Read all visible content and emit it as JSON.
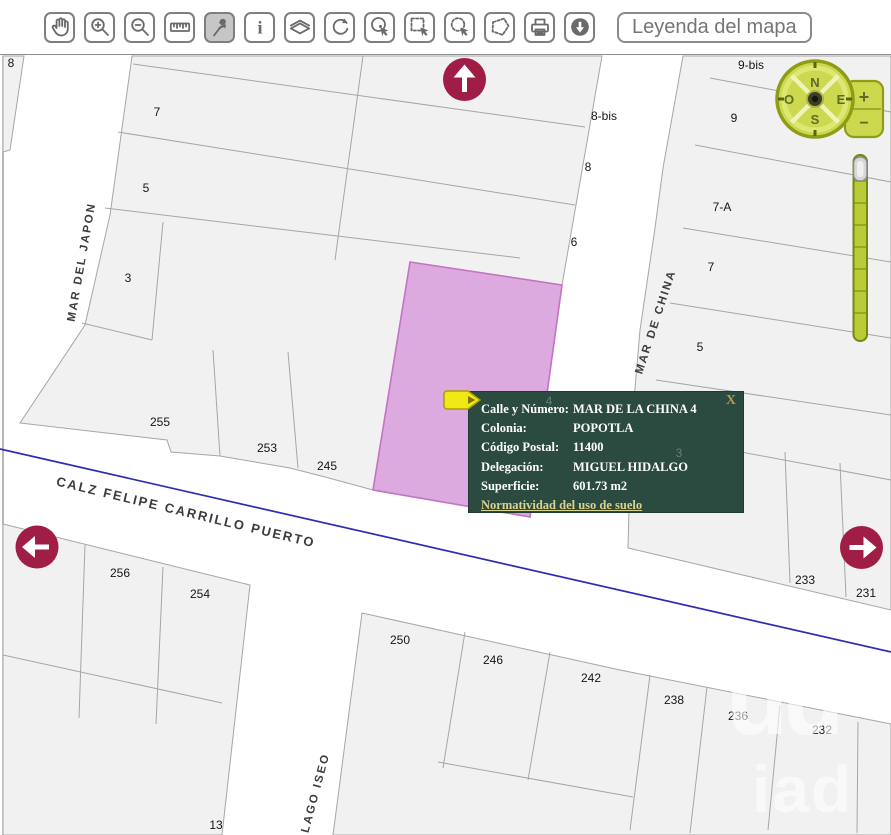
{
  "toolbar": {
    "buttons": [
      {
        "name": "pan",
        "icon": "hand-icon",
        "active": false
      },
      {
        "name": "zoom-in",
        "icon": "magnifier-plus-icon",
        "active": false
      },
      {
        "name": "zoom-out",
        "icon": "magnifier-minus-icon",
        "active": false
      },
      {
        "name": "measure",
        "icon": "ruler-icon",
        "active": false
      },
      {
        "name": "pin",
        "icon": "pushpin-icon",
        "active": true
      },
      {
        "name": "info",
        "icon": "info-icon",
        "active": false
      },
      {
        "name": "layers",
        "icon": "layers-icon",
        "active": false
      },
      {
        "name": "refresh",
        "icon": "refresh-icon",
        "active": false
      },
      {
        "name": "select-point",
        "icon": "circle-point-cursor-icon",
        "active": false
      },
      {
        "name": "select-rectangle",
        "icon": "dashed-rectangle-cursor-icon",
        "active": false
      },
      {
        "name": "select-circle",
        "icon": "dashed-circle-cursor-icon",
        "active": false
      },
      {
        "name": "select-polygon",
        "icon": "dashed-polygon-icon",
        "active": false
      },
      {
        "name": "print",
        "icon": "printer-icon",
        "active": false
      },
      {
        "name": "download",
        "icon": "download-icon",
        "active": false
      }
    ],
    "legend_button": "Leyenda del mapa"
  },
  "map": {
    "street_labels": [
      {
        "text": "MAR DEL JAPON",
        "x": 82,
        "y": 262,
        "angle": -80,
        "size": 11.5
      },
      {
        "text": "MAR DE CHINA",
        "x": 656,
        "y": 322,
        "angle": -72,
        "size": 11.5
      },
      {
        "text": "CALZ FELIPE CARRILLO PUERTO",
        "x": 186,
        "y": 512,
        "angle": 13.5,
        "size": 13
      },
      {
        "text": "LAGO ISEO",
        "x": 316,
        "y": 793,
        "angle": -75,
        "size": 11.5
      }
    ],
    "parcel_labels": [
      {
        "text": "8",
        "x": 11,
        "y": 63
      },
      {
        "text": "7",
        "x": 157,
        "y": 112
      },
      {
        "text": "5",
        "x": 146,
        "y": 188
      },
      {
        "text": "3",
        "x": 128,
        "y": 278
      },
      {
        "text": "8-bis",
        "x": 604,
        "y": 116
      },
      {
        "text": "8",
        "x": 588,
        "y": 167
      },
      {
        "text": "6",
        "x": 574,
        "y": 242
      },
      {
        "text": "9-bis",
        "x": 751,
        "y": 65
      },
      {
        "text": "9",
        "x": 734,
        "y": 118
      },
      {
        "text": "7-A",
        "x": 722,
        "y": 207
      },
      {
        "text": "7",
        "x": 711,
        "y": 267
      },
      {
        "text": "5",
        "x": 700,
        "y": 347
      },
      {
        "text": "255",
        "x": 160,
        "y": 422
      },
      {
        "text": "253",
        "x": 267,
        "y": 448
      },
      {
        "text": "245",
        "x": 327,
        "y": 466
      },
      {
        "text": "233",
        "x": 805,
        "y": 580
      },
      {
        "text": "231",
        "x": 866,
        "y": 593
      },
      {
        "text": "256",
        "x": 120,
        "y": 573
      },
      {
        "text": "254",
        "x": 200,
        "y": 594
      },
      {
        "text": "250",
        "x": 400,
        "y": 640
      },
      {
        "text": "246",
        "x": 493,
        "y": 660
      },
      {
        "text": "242",
        "x": 591,
        "y": 678
      },
      {
        "text": "238",
        "x": 674,
        "y": 700
      },
      {
        "text": "236",
        "x": 738,
        "y": 716
      },
      {
        "text": "232",
        "x": 822,
        "y": 730
      },
      {
        "text": "13",
        "x": 216,
        "y": 825
      }
    ],
    "ghost_labels": [
      {
        "text": "4",
        "x": 549,
        "y": 401
      },
      {
        "text": "3",
        "x": 679,
        "y": 453
      }
    ],
    "compass": {
      "north": "N",
      "south": "S",
      "east": "E",
      "west": "O",
      "zoom_in": "+",
      "zoom_out": "−"
    }
  },
  "popup": {
    "rows": [
      {
        "label": "Calle y Número:",
        "value": "MAR DE LA CHINA 4"
      },
      {
        "label": "Colonia:",
        "value": "POPOTLA"
      },
      {
        "label": "Código Postal:",
        "value": "11400"
      },
      {
        "label": "Delegación:",
        "value": "MIGUEL HIDALGO"
      },
      {
        "label": "Superficie:",
        "value": "601.73 m2"
      }
    ],
    "link": "Normatividad del uso de suelo",
    "close": "X"
  },
  "watermark": {
    "line1": "uu",
    "line2": "iad"
  },
  "colors": {
    "highlight_parcel": "#dcaade",
    "popup_bg": "#2b4a40",
    "nav_arrow": "#a01d45",
    "compass": "#ccd94f",
    "street_line": "#2b2bb4"
  }
}
